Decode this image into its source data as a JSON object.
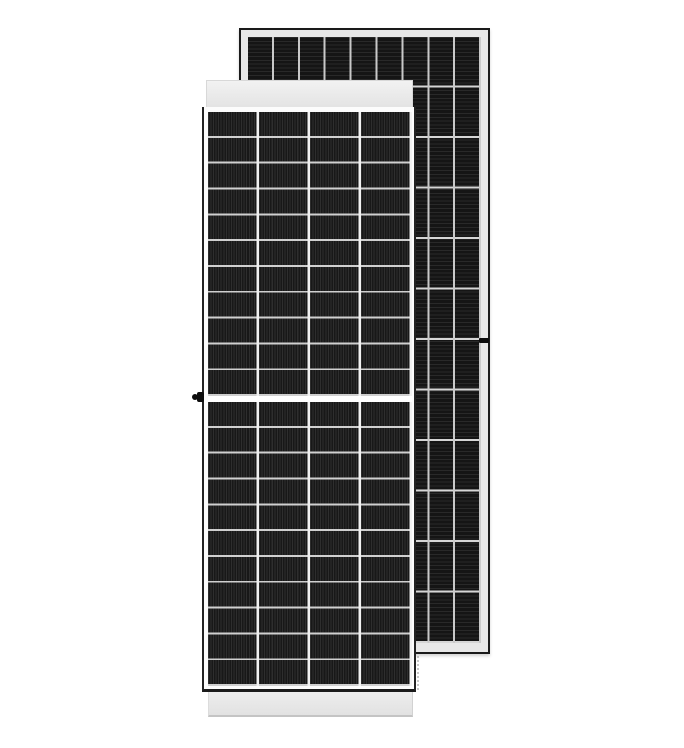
{
  "scene": {
    "description": "Product photo of two framed monocrystalline solar PV modules on a white background: one module shown from the front (white frame, dark half-cut cells) overlapping a second module shown from the back",
    "background_color": "#ffffff"
  },
  "front_panel": {
    "label": "solar-panel-front-view",
    "frame_color": "#fcfcfc",
    "frame_edge_color": "#222222",
    "top_rail_color": "#e9e9e9",
    "bottom_rail_color": "#e7e7e7",
    "cell_color": "#181818",
    "cell_finger_color": "#2e2e2e",
    "row_separator_color": "#cfcfcf",
    "column_separator_color": "#f1f1f1",
    "columns": 4,
    "rows": 22,
    "half_cut_center_gap": true,
    "center_gap_color": "#ffffff",
    "grounding_lug": {
      "present": true,
      "color": "#0d0d0d",
      "side": "left-frame-edge"
    }
  },
  "back_panel": {
    "label": "solar-panel-back-view",
    "frame_color": "#e7e7e7",
    "frame_edge_color": "#1a1a1a",
    "cell_color": "#151515",
    "cell_ribbon_color": "#292929",
    "row_separator_color": "#d5d5d5",
    "column_separator_color": "#c9c9c9",
    "columns": 9,
    "rows": 12,
    "grounding_screw": {
      "present": true,
      "color": "#0c0c0c",
      "side": "right-frame-edge"
    }
  }
}
